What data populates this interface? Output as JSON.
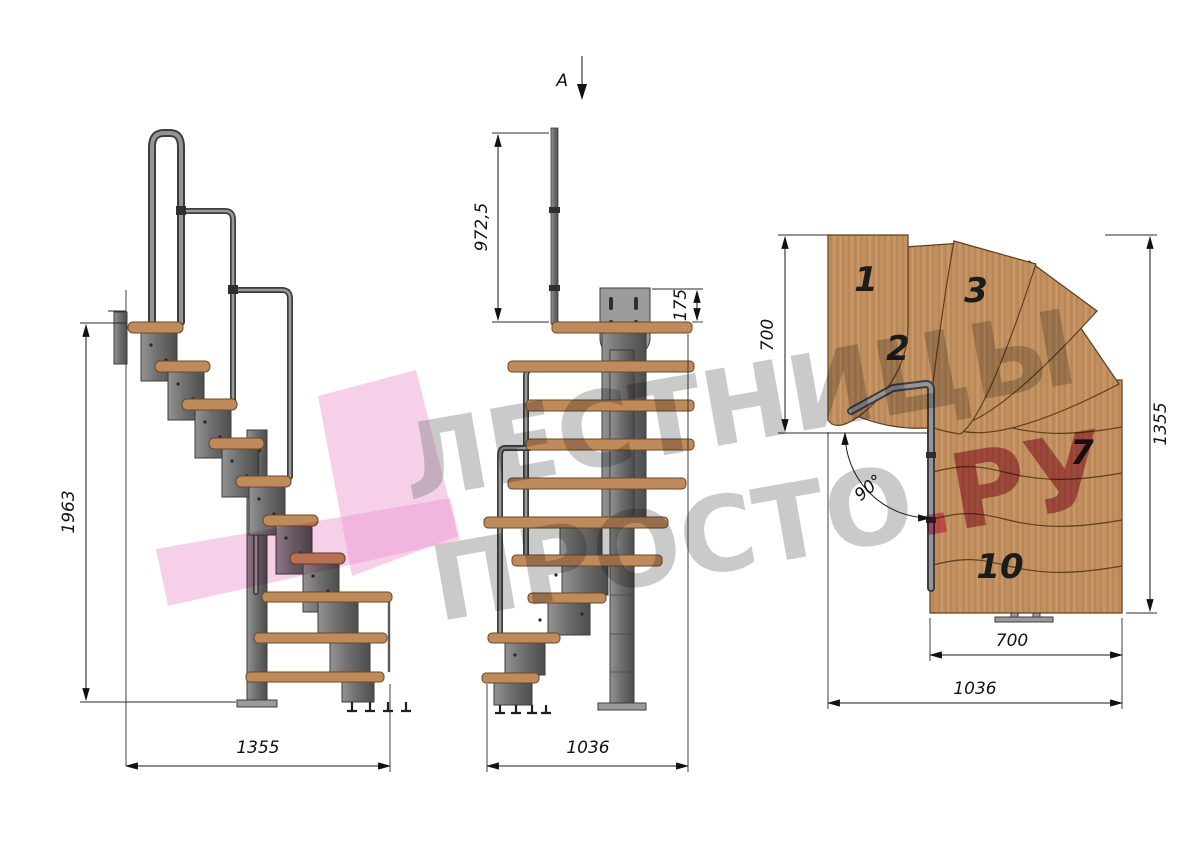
{
  "watermark": {
    "line1": "ЛЕСТНИЦЫ",
    "line2": "ПРОСТО",
    "dot": ".",
    "ru": "РУ"
  },
  "side_view": {
    "height_mm": "1963",
    "width_mm": "1355"
  },
  "front_view": {
    "section_label": "A",
    "rail_height_mm": "972,5",
    "bracket_mm": "175",
    "width_mm": "1036"
  },
  "plan_view": {
    "entry_depth_mm": "700",
    "total_depth_mm": "1355",
    "turn_angle": "90°",
    "flight_width_mm": "700",
    "total_width_mm": "1036",
    "treads": {
      "n1": "1",
      "n2": "2",
      "n3": "3",
      "n7": "7",
      "n10": "10"
    }
  },
  "colors": {
    "wood": "#c2905f",
    "wood_outline": "#5f3d1e",
    "metal": "#777777",
    "dimension": "#1a1a1a",
    "watermark_gray": "#9a9a9a",
    "watermark_pink": "#ec9ad2",
    "watermark_red": "#a8254e"
  }
}
